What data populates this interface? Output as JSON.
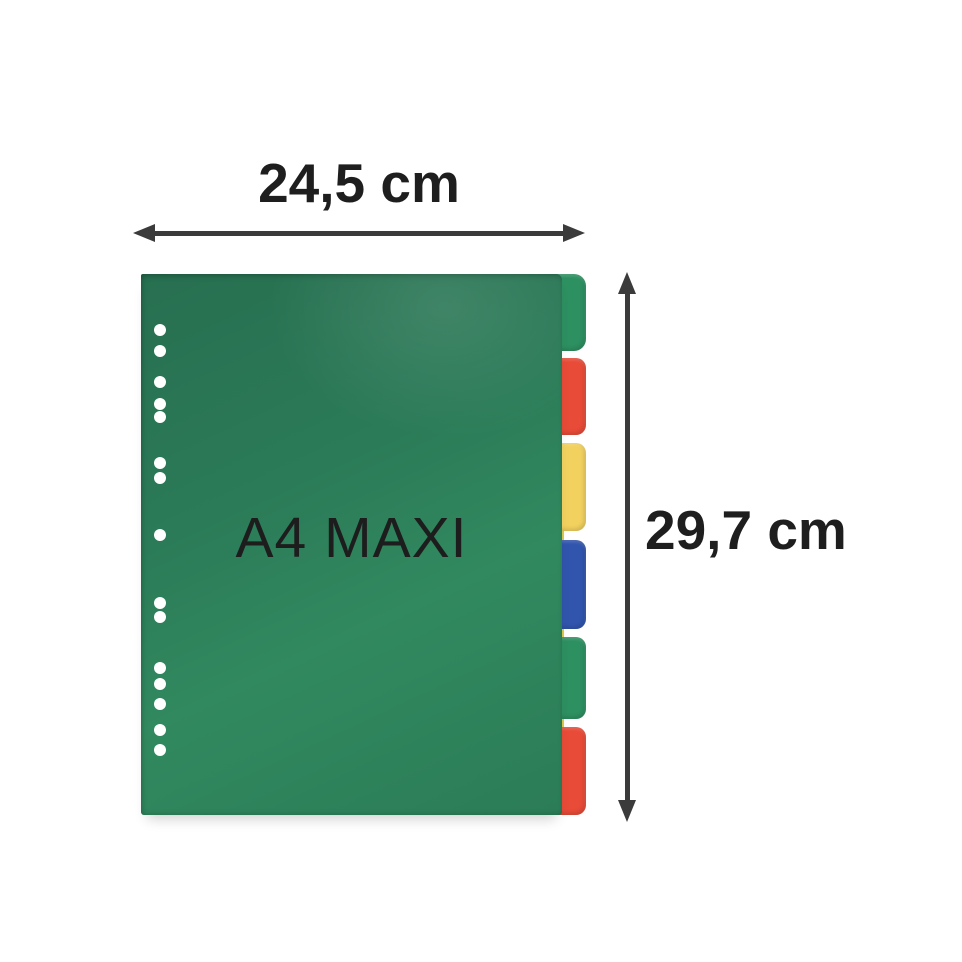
{
  "product": {
    "label": "A4 MAXI",
    "type": "divider-set-with-colored-tabs"
  },
  "annotations": {
    "width": {
      "label": "24,5 cm"
    },
    "height": {
      "label": "29,7 cm"
    },
    "arrow_color": "#3b3b3b",
    "text_color": "#1e1e1e"
  },
  "divider": {
    "sheet_color": "#2b7b58",
    "label_color": "#1d1d1d",
    "hole_color": "#ffffff",
    "hole_count": 15,
    "edge_stripe_color": "#d9c94f",
    "tabs": [
      {
        "name": "green",
        "color": "#2d9061"
      },
      {
        "name": "red",
        "color": "#e84b38"
      },
      {
        "name": "yellow",
        "color": "#f2d15f"
      },
      {
        "name": "blue",
        "color": "#3155ad"
      },
      {
        "name": "green",
        "color": "#2d9061"
      },
      {
        "name": "red",
        "color": "#e84b38"
      }
    ]
  },
  "background_color": "#ffffff"
}
